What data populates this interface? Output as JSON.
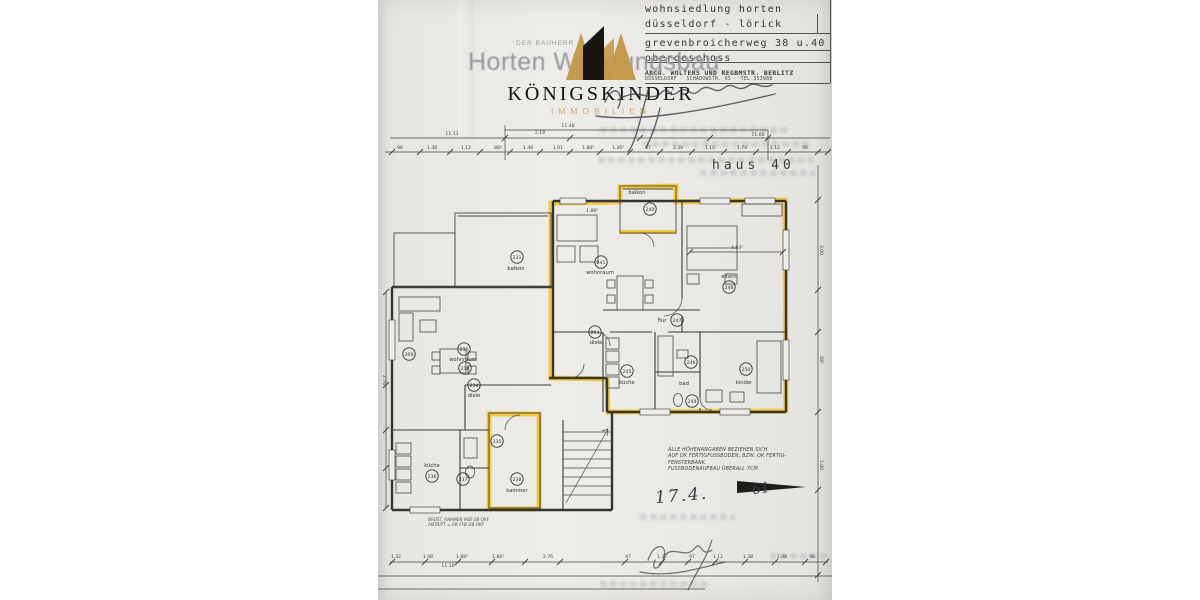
{
  "title_block": {
    "line1": "wohnsiedlung horten",
    "line2": "düsseldorf - lörick",
    "line3": "grevenbroicherweg  38 u.40",
    "line4": "obergeschoss",
    "arch1": "ARCH. WOLTERS UND REGBMSTR. BERLITZ",
    "arch2": "DÜSSELDORF · SCHADOWSTR. 65 · TEL 353988"
  },
  "ghost_title": {
    "small": "DER BAUHERR",
    "large": "Horten Wohnungsbau"
  },
  "watermark": {
    "brand": "KÖNIGSKINDER",
    "sub": "IMMOBILIEN",
    "gold": "#c49a4e",
    "black": "#181613"
  },
  "plan": {
    "house_label": "haus 40",
    "highlight_color": "#f2c32a",
    "ink_color": "#35342f",
    "handwriting": {
      "date": "17.4.",
      "year": "61"
    },
    "note_main": {
      "lines": [
        "ALLE HÖHENANGABEN BEZIEHEN SICH",
        "AUF OK FERTIGFUSSBODEN, BZW. OK FERTIG-",
        "FENSTERBANK.",
        "FUSSBODENAUFBAU ÜBERALL 7CM."
      ]
    },
    "note_small": {
      "lines": [
        "BRÜST. RAHMEN 90B ÜB OKF",
        "ANTRITT = OK FFB ÜB OKF"
      ]
    },
    "rooms": [
      {
        "cx": 650,
        "cy": 209,
        "num": "240",
        "label": "balkon",
        "lx": 637,
        "ly": 194
      },
      {
        "cx": 601,
        "cy": 262,
        "num": "241",
        "label": "wohnraum",
        "lx": 600,
        "ly": 274
      },
      {
        "cx": 729,
        "cy": 287,
        "num": "248",
        "label": "eltern",
        "lx": 729,
        "ly": 278
      },
      {
        "cx": 746,
        "cy": 369,
        "num": "250",
        "label": "kinder",
        "lx": 744,
        "ly": 384
      },
      {
        "cx": 627,
        "cy": 371,
        "num": "245",
        "label": "küche",
        "lx": 627,
        "ly": 384
      },
      {
        "cx": 691,
        "cy": 362,
        "num": "246",
        "label": "bad",
        "lx": 684,
        "ly": 385
      },
      {
        "cx": 692,
        "cy": 401,
        "num": "249"
      },
      {
        "cx": 595,
        "cy": 332,
        "num": "244",
        "label": "diele",
        "lx": 596,
        "ly": 344
      },
      {
        "cx": 677,
        "cy": 320,
        "num": "247",
        "label": "flur",
        "lx": 662,
        "ly": 322
      },
      {
        "cx": 517,
        "cy": 257,
        "num": "231",
        "label": "balkon",
        "lx": 516,
        "ly": 270
      },
      {
        "cx": 464,
        "cy": 349,
        "num": "230",
        "label": "wohnraum",
        "lx": 463,
        "ly": 361
      },
      {
        "cx": 409,
        "cy": 354,
        "num": "209"
      },
      {
        "cx": 465,
        "cy": 368,
        "num": "210"
      },
      {
        "cx": 474,
        "cy": 385,
        "num": "234",
        "label": "diele",
        "lx": 474,
        "ly": 397
      },
      {
        "cx": 432,
        "cy": 476,
        "num": "236",
        "label": "küche",
        "lx": 432,
        "ly": 467
      },
      {
        "cx": 463,
        "cy": 479,
        "num": "237"
      },
      {
        "cx": 517,
        "cy": 479,
        "num": "238",
        "label": "kammer",
        "lx": 517,
        "ly": 492
      },
      {
        "cx": 497,
        "cy": 441,
        "num": "235"
      }
    ],
    "dims": [
      {
        "x": 568,
        "y": 127,
        "t": "11.48"
      },
      {
        "x": 452,
        "y": 135,
        "t": "11.13"
      },
      {
        "x": 758,
        "y": 136,
        "t": "11.60"
      },
      {
        "x": 540,
        "y": 134,
        "t": "2.19"
      },
      {
        "x": 400,
        "y": 149,
        "t": "96"
      },
      {
        "x": 432,
        "y": 149,
        "t": "1.38"
      },
      {
        "x": 466,
        "y": 149,
        "t": "1.12"
      },
      {
        "x": 498,
        "y": 149,
        "t": "88⁵"
      },
      {
        "x": 528,
        "y": 149,
        "t": "1.48"
      },
      {
        "x": 558,
        "y": 149,
        "t": "1.01"
      },
      {
        "x": 588,
        "y": 149,
        "t": "1.88⁵"
      },
      {
        "x": 618,
        "y": 149,
        "t": "1.36⁵"
      },
      {
        "x": 648,
        "y": 149,
        "t": "47"
      },
      {
        "x": 678,
        "y": 149,
        "t": "2.38"
      },
      {
        "x": 710,
        "y": 149,
        "t": "1.10"
      },
      {
        "x": 742,
        "y": 149,
        "t": "1.74"
      },
      {
        "x": 775,
        "y": 149,
        "t": "1.12"
      },
      {
        "x": 805,
        "y": 149,
        "t": "96"
      },
      {
        "x": 737,
        "y": 249,
        "t": "4.63⁵"
      },
      {
        "x": 592,
        "y": 212,
        "t": "1.88⁵"
      },
      {
        "x": 820,
        "y": 250,
        "t": "3.00",
        "r": 90
      },
      {
        "x": 820,
        "y": 360,
        "t": "88⁵",
        "r": 90
      },
      {
        "x": 820,
        "y": 465,
        "t": "1.00",
        "r": 90
      },
      {
        "x": 383,
        "y": 380,
        "t": "2.76",
        "r": 90
      },
      {
        "x": 396,
        "y": 558,
        "t": "1.32"
      },
      {
        "x": 428,
        "y": 558,
        "t": "1.48"
      },
      {
        "x": 462,
        "y": 558,
        "t": "1.88⁵"
      },
      {
        "x": 498,
        "y": 558,
        "t": "1.86⁵"
      },
      {
        "x": 548,
        "y": 558,
        "t": "2.76"
      },
      {
        "x": 628,
        "y": 558,
        "t": "47"
      },
      {
        "x": 662,
        "y": 558,
        "t": "1.32"
      },
      {
        "x": 692,
        "y": 558,
        "t": "97"
      },
      {
        "x": 718,
        "y": 558,
        "t": "1.12"
      },
      {
        "x": 748,
        "y": 558,
        "t": "1.38"
      },
      {
        "x": 782,
        "y": 558,
        "t": "1.48"
      },
      {
        "x": 812,
        "y": 558,
        "t": "96"
      },
      {
        "x": 448,
        "y": 567,
        "t": "11.10"
      }
    ]
  }
}
